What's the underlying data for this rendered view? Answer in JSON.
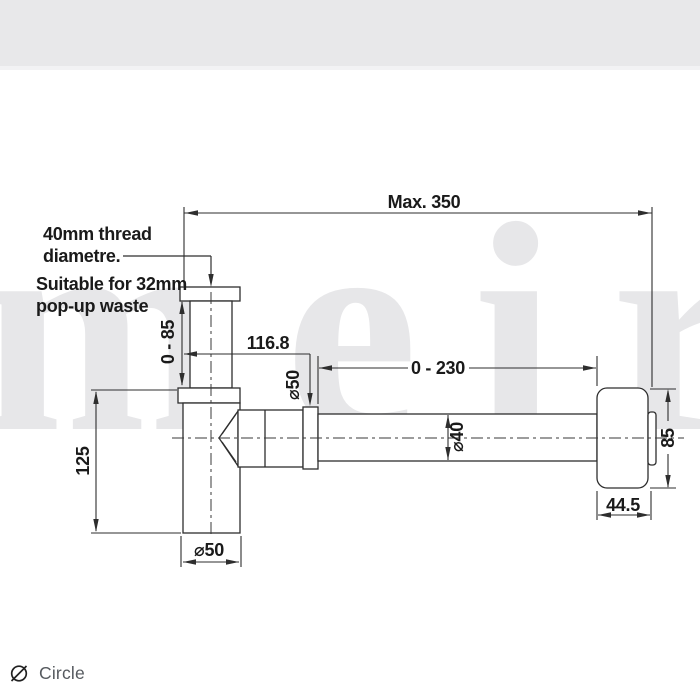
{
  "page": {
    "header_band_color": "#e8e8ea",
    "header_strip_color": "#f2f2f4",
    "background": "#ffffff"
  },
  "watermark": {
    "text": "meir",
    "color": "#e7e7e9"
  },
  "drawing": {
    "line_color": "#2e2e2e",
    "text_color": "#1a1a1a",
    "notes": {
      "thread_line1": "40mm thread",
      "thread_line2": "diametre.",
      "waste_line1": "Suitable for 32mm",
      "waste_line2": "pop-up waste"
    },
    "dimensions": {
      "overall_length": "Max. 350",
      "inlet_adjust": "0 - 85",
      "inlet_offset": "116.8",
      "nut_diameter": "⌀50",
      "outlet_adjust": "0 - 230",
      "pipe_diameter": "⌀40",
      "flange_size": "85",
      "flange_depth": "44.5",
      "body_height": "125",
      "body_diameter": "⌀50"
    }
  },
  "footer": {
    "label": "Circle"
  }
}
